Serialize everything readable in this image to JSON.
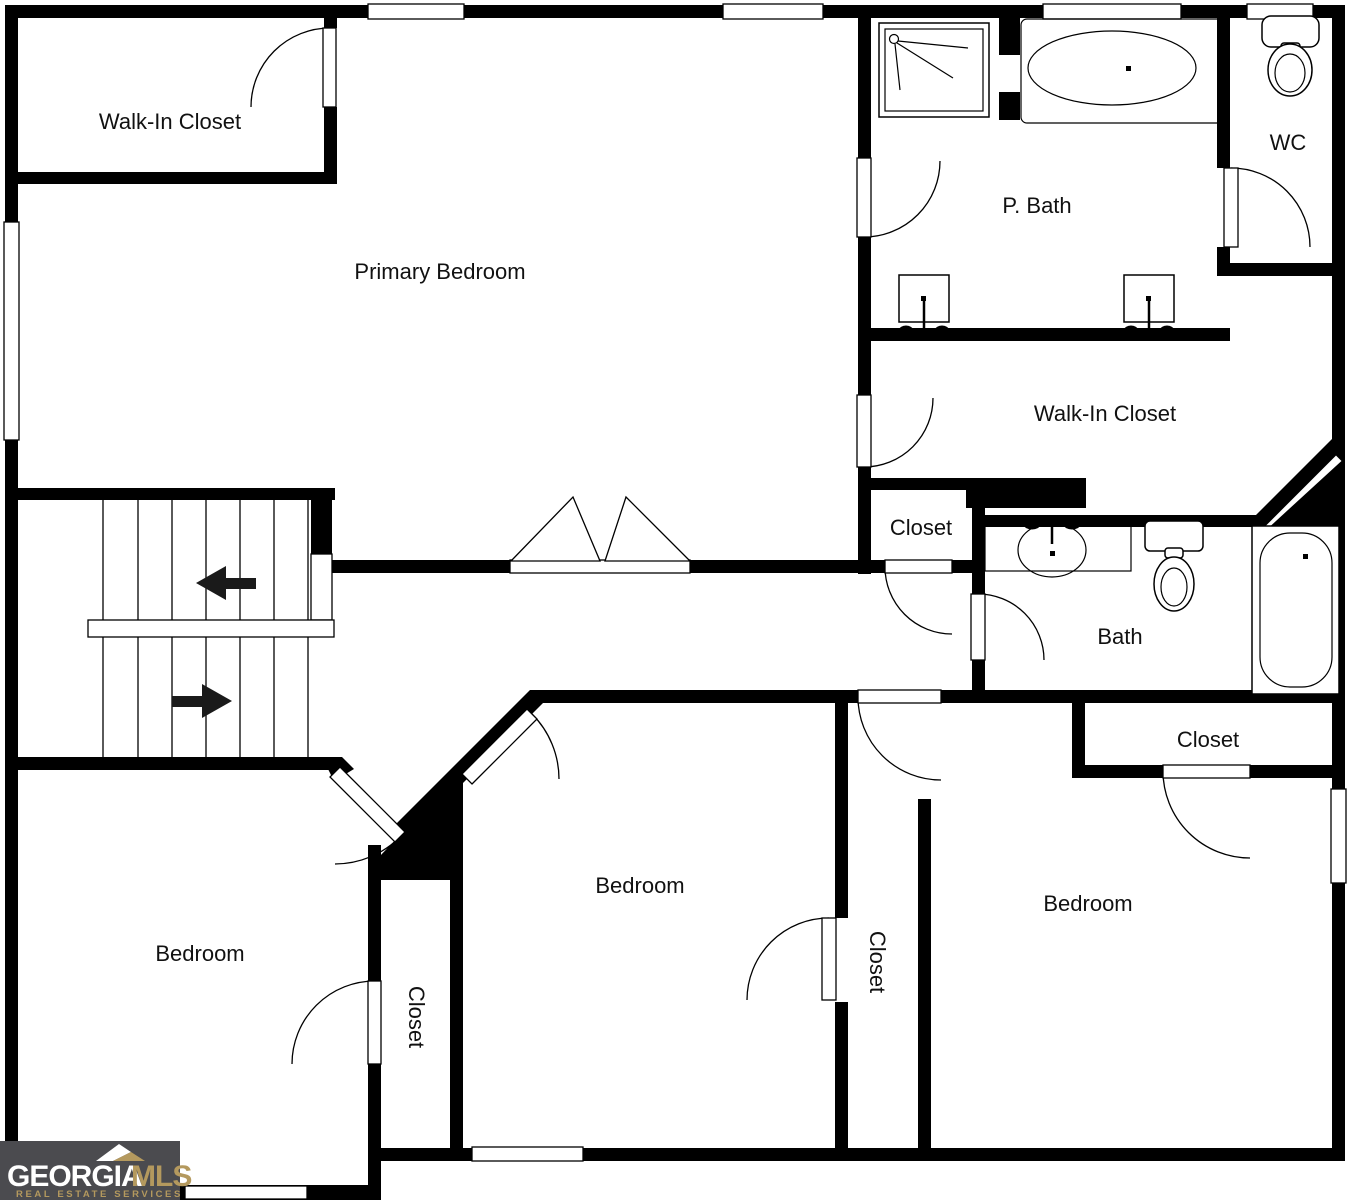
{
  "title": "Second floor residential floor plan",
  "rooms": {
    "walk_in_closet_tl": "Walk-In Closet",
    "primary_bedroom": "Primary Bedroom",
    "p_bath": "P. Bath",
    "wc": "WC",
    "walk_in_closet_r": "Walk-In Closet",
    "closet_hall": "Closet",
    "bath": "Bath",
    "closet_br": "Closet",
    "bedroom_left": "Bedroom",
    "bedroom_mid": "Bedroom",
    "bedroom_right": "Bedroom",
    "closet_strip_left": "Closet",
    "closet_strip_mid": "Closet"
  },
  "icons": {
    "shower": "shower-icon",
    "soaking_tub": "bathtub-icon",
    "wc_toilet": "toilet-icon",
    "vanity_sink_left": "sink-icon",
    "vanity_sink_right": "sink-icon",
    "bath_sink": "sink-icon",
    "bath_toilet": "toilet-icon",
    "bath_tub": "bathtub-icon",
    "stairs_up_arrow": "left-arrow-icon",
    "stairs_down_arrow": "right-arrow-icon"
  },
  "logo": {
    "brand_primary": "GEORGIA",
    "brand_secondary": "MLS",
    "tagline": "REAL ESTATE SERVICES"
  },
  "colors": {
    "wall": "#000000",
    "background": "#ffffff",
    "logo_bg": "#4b4b4f",
    "logo_text": "#ffffff",
    "logo_accent": "#b4995e"
  }
}
